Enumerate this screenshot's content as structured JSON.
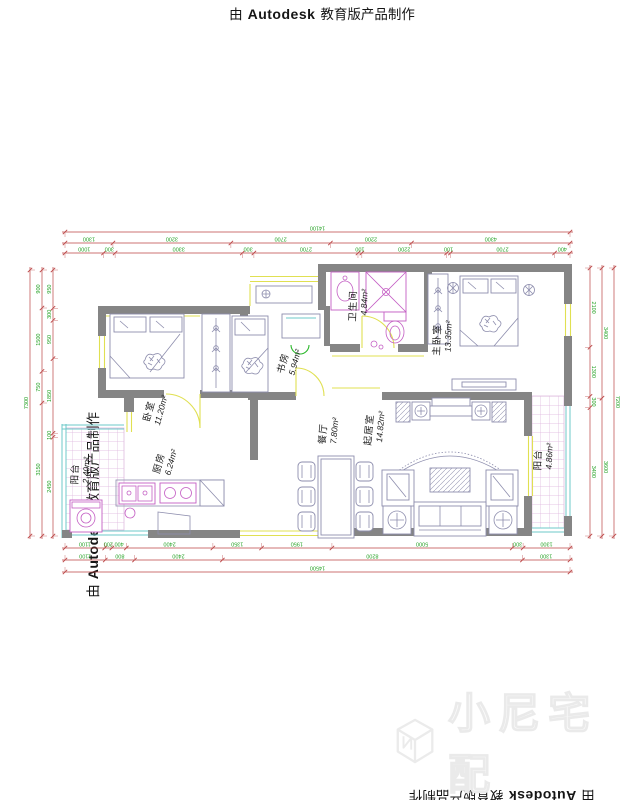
{
  "watermark": {
    "prefix": "由",
    "brand": "Autodesk",
    "suffix": "教育版产品制作"
  },
  "logo": {
    "text": "小尼宅配"
  },
  "rooms": {
    "bedroom": {
      "name": "卧室",
      "area": "11.20m²"
    },
    "study": {
      "name": "书房",
      "area": "5.94m²"
    },
    "bathroom": {
      "name": "卫生间",
      "area": "4.84m²"
    },
    "master_bedroom": {
      "name": "主卧室",
      "area": "13.35m²"
    },
    "dining": {
      "name": "餐厅",
      "area": "7.80m²"
    },
    "living": {
      "name": "起居室",
      "area": "14.82m²"
    },
    "kitchen": {
      "name": "厨房",
      "area": "6.24m²"
    },
    "balcony_left": {
      "name": "阳台",
      "area": "2.40m²"
    },
    "balcony_right": {
      "name": "阳台",
      "area": "4.86m²"
    }
  },
  "dimensions": {
    "top_total": "14100",
    "top_row1": [
      "1300",
      "3200",
      "2700",
      "2200",
      "4300"
    ],
    "top_row2": [
      "1000",
      "300",
      "3300",
      "300",
      "2700",
      "100",
      "2200",
      "100",
      "2700",
      "400"
    ],
    "bottom_row1": [
      "1100",
      "200",
      "400",
      "2400",
      "1350",
      "1950",
      "5000",
      "300",
      "1300"
    ],
    "bottom_row2": [
      "1100",
      "800",
      "2400",
      "8200",
      "1300"
    ],
    "bottom_total": "14500",
    "left_total": "7300",
    "left_row1": [
      "900",
      "1500",
      "750",
      "3150"
    ],
    "left_row2": [
      "950",
      "300",
      "950",
      "1850",
      "100",
      "2450"
    ],
    "right_row1": [
      "3400",
      "3600"
    ],
    "right_row2": [
      "2100",
      "1300",
      "300",
      "3400"
    ],
    "right_total": "7200"
  },
  "colors": {
    "wall": "#858585",
    "furniture": "#8d8dad",
    "fixture_magenta": "#c45fc4",
    "window_yellow": "#e0e052",
    "glazing_cyan": "#6cc9c9",
    "door_green": "#2db82d",
    "dim_line_red": "#bb4444",
    "dim_text_green": "#23a123"
  }
}
